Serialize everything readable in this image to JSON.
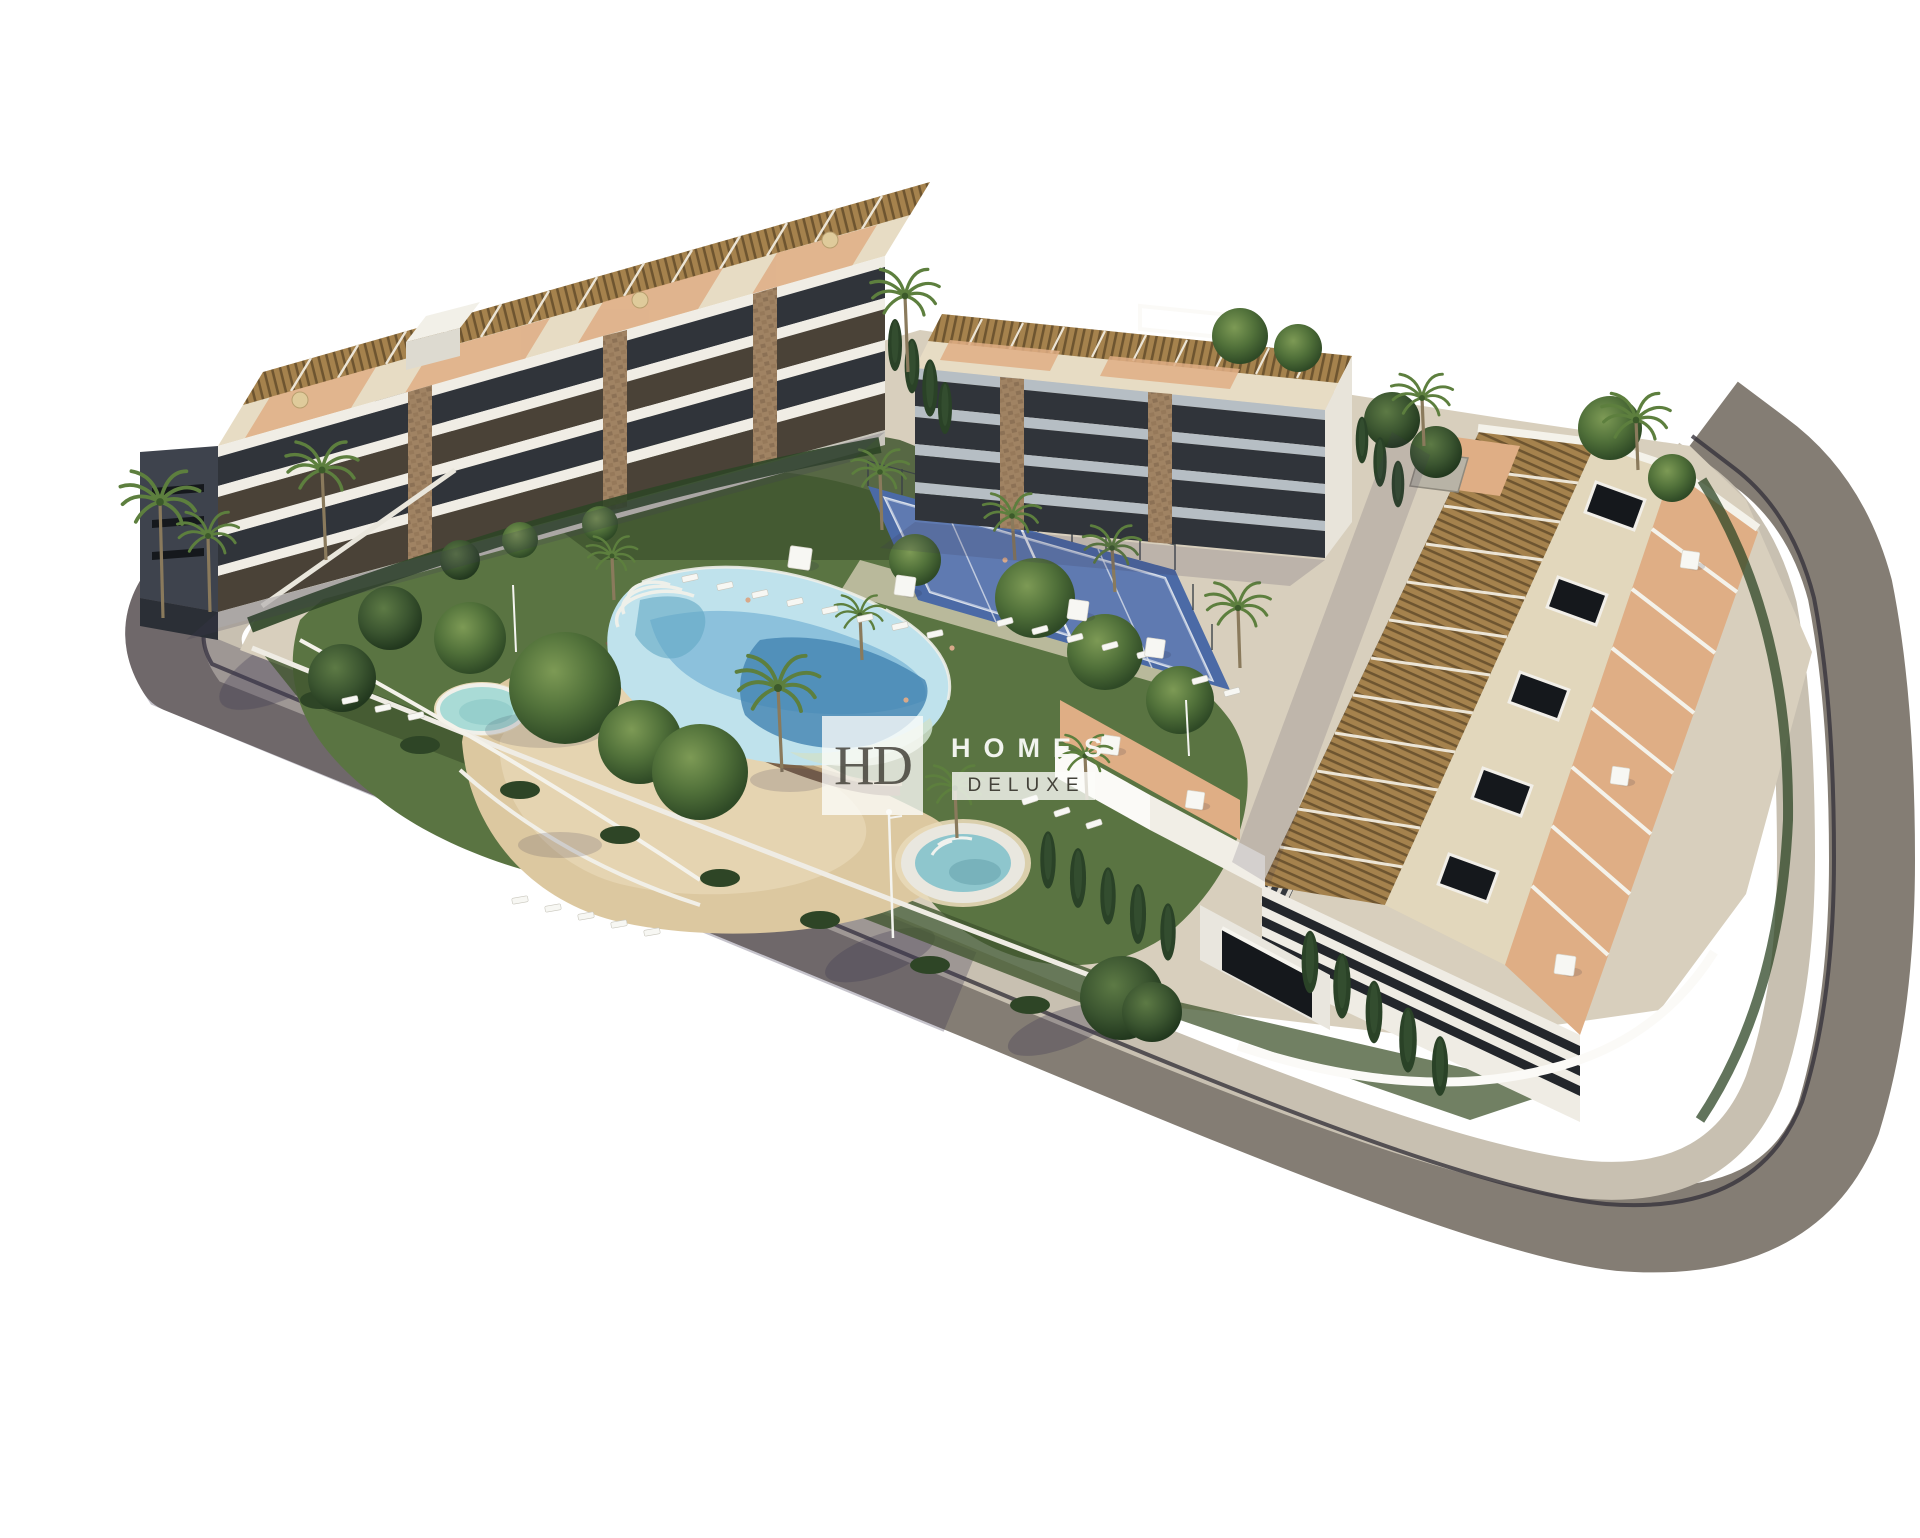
{
  "watermark": {
    "monogram": "HD",
    "name_top": "HOMES",
    "name_bottom": "DELUXE"
  },
  "palette": {
    "bg": "#ffffff",
    "road": "#847d74",
    "roadShadow": "#3f3952",
    "sidewalk": "#c8c0b1",
    "curb": "#37333c",
    "siteBase": "#d8cfbd",
    "wallWhite": "#efece4",
    "wallBright": "#fbfaf7",
    "slab": "#f0ede5",
    "slabCool": "#b6bec4",
    "recess": "#30343a",
    "recessWarm": "#4a4237",
    "endWall": "#3e434d",
    "windowSlit": "#15181c",
    "stone": "#a08363",
    "stoneDark": "#7c6248",
    "roofCream": "#e7dcc4",
    "roofBeige": "#e2d7bc",
    "pergola": "#a5824d",
    "pergolaDark": "#6e5530",
    "pergolaGap": "#ece5d6",
    "terrace": "#dfae85",
    "terraceLight": "#ecd9c2",
    "lawn": "#5a7442",
    "lawnDark": "#41562f",
    "hedge": "#2e4526",
    "cypress": "#2a4227",
    "tree": "#4a6836",
    "palm": "#5d7f3e",
    "palmDark": "#3c5a2a",
    "trunk": "#8a7a5c",
    "poolLight": "#bfe2ec",
    "poolMid": "#7fb9d8",
    "poolDeep": "#4283b2",
    "poolTeal": "#62a8c4",
    "poolRim": "#eef0ea",
    "poolBeach": "#cfe0cd",
    "kidsPool": "#a9dbd6",
    "jacuzzi": "#8ec6cd",
    "sand": "#dcc8a0",
    "sandLight": "#e8d9b8",
    "courtBlue": "#4b6aa6",
    "courtBlueLight": "#7d94c4",
    "courtLine": "#e8ecf2",
    "fence": "#3a4147",
    "furniture": "#f7f7f3",
    "parasolTan": "#dfcb9b",
    "wmBox": "rgba(252,252,250,0.78)",
    "wmDark": "#44423a",
    "wmLight": "#fafaf8"
  }
}
